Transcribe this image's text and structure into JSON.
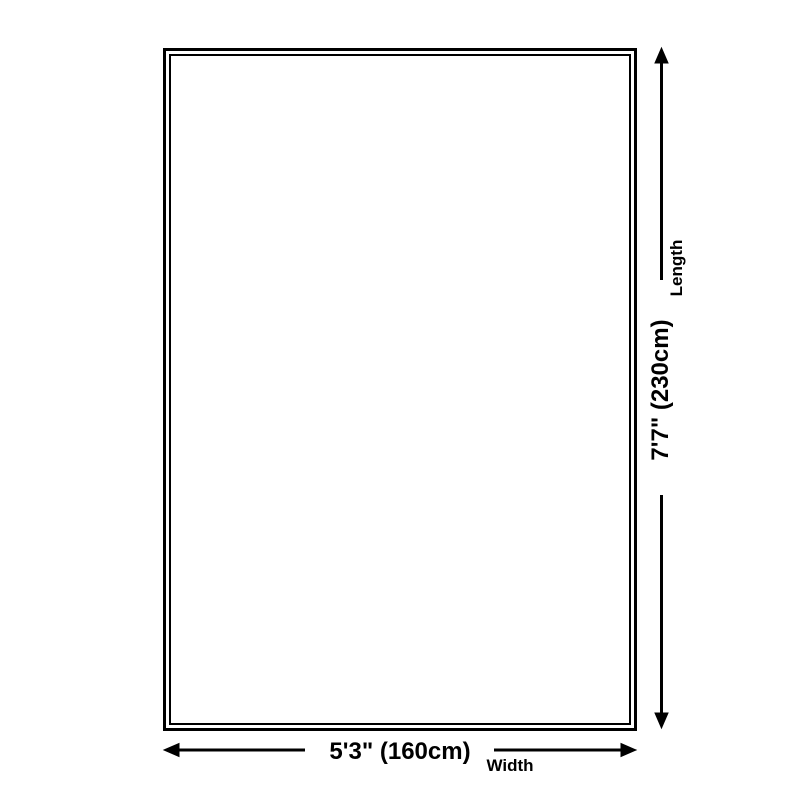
{
  "diagram": {
    "type": "product-dimension-diagram",
    "background_color": "#ffffff",
    "line_color": "#000000",
    "dimensions": {
      "width": {
        "value": "5'3\" (160cm)",
        "label": "Width"
      },
      "length": {
        "value": "7'7\" (230cm)",
        "label": "Length"
      }
    }
  }
}
